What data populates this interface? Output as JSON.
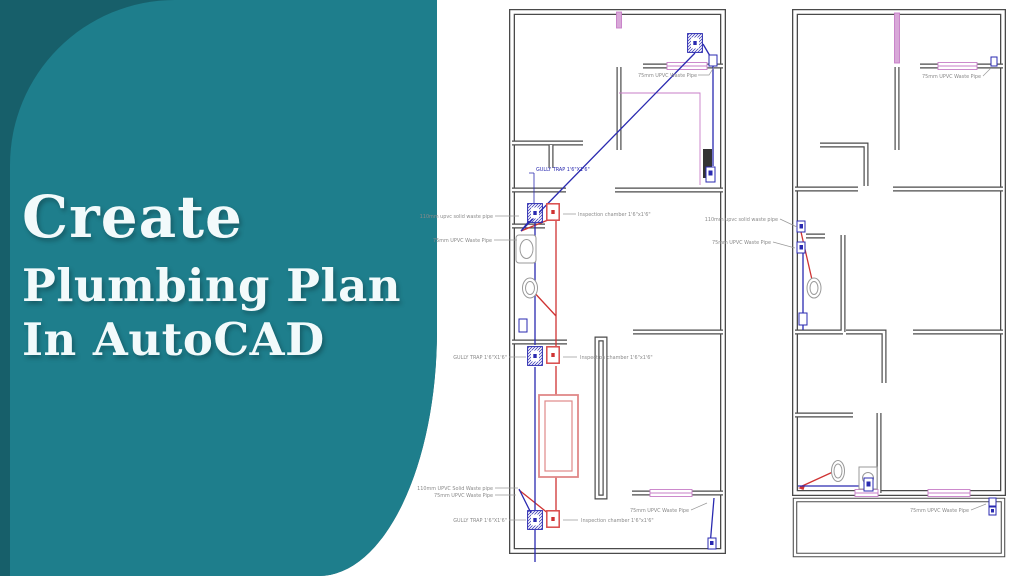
{
  "panel": {
    "title_line1": "Create",
    "title_line2": "Plumbing Plan",
    "title_line3": "In AutoCAD"
  },
  "labels": {
    "gully_trap": "GULLY TRAP 1'6\"X1'6\"",
    "inspection_chamber": "Inspection chamber 1'6\"x1'6\"",
    "waste_pipe_75": "75mm UPVC Waste Pipe",
    "solid_waste_110_lower": "110mm upvc solid waste pipe",
    "solid_waste_110_mixed": "110mm UPVC Solid Waste pipe"
  },
  "colors": {
    "teal_dark": "#175f6a",
    "teal_light": "#1e7e8c",
    "title_text": "#f2fafb",
    "pipe_blue": "#2a2ab0",
    "pipe_red": "#cf3333",
    "septic_red": "#e08888",
    "window_pink": "#c77dc7",
    "wall_gray": "#4a4a4a",
    "label_gray": "#8a8a8a"
  }
}
